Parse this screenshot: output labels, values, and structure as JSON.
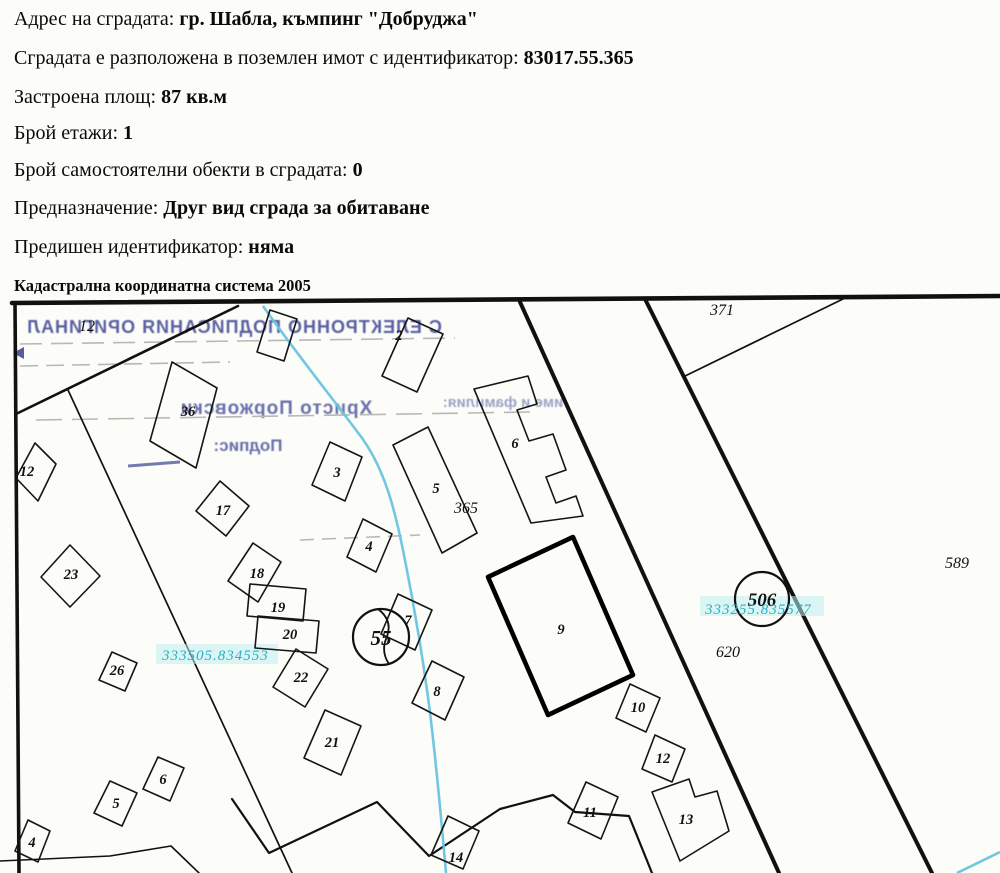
{
  "header": {
    "rows": [
      {
        "label": "Адрес на сградата: ",
        "value": "гр. Шабла, къмпинг \"Добруджа\""
      },
      {
        "label": "Сградата е разположена в поземлен имот с идентификатор: ",
        "value": "83017.55.365"
      },
      {
        "label": "Застроена площ: ",
        "value": "87 кв.м"
      },
      {
        "label": "Брой етажи: ",
        "value": "1"
      },
      {
        "label": "Брой самостоятелни обекти в сградата: ",
        "value": "0"
      },
      {
        "label": "Предназначение: ",
        "value": "Друг вид сграда за обитаване"
      },
      {
        "label": "Предишен идентификатор: ",
        "value": "няма"
      }
    ],
    "coord_system": "Кадастрална координатна система 2005"
  },
  "map": {
    "stamp": {
      "line1": "С ЕЛЕКТРОННО ПОДПИСАНИЯ ОРИГИНАЛ",
      "line2_label": "име и фамилия:",
      "line2_name": "Христо Поржовски",
      "line3": "Подпис:"
    },
    "colors": {
      "stream_blue": "#69c4e0",
      "cyan_label": "#2ab0c4",
      "stamp_blue": "#2b358a"
    },
    "labels": [
      {
        "text": "12",
        "x": 87,
        "y": 331,
        "cls": "parcel"
      },
      {
        "text": "371",
        "x": 722,
        "y": 315,
        "cls": "parcel"
      },
      {
        "text": "365",
        "x": 466,
        "y": 513,
        "cls": "parcel"
      },
      {
        "text": "589",
        "x": 957,
        "y": 568,
        "cls": "parcel"
      },
      {
        "text": "620",
        "x": 728,
        "y": 657,
        "cls": "parcel"
      },
      {
        "text": "2",
        "x": 399,
        "y": 340,
        "cls": "bldg"
      },
      {
        "text": "36",
        "x": 188,
        "y": 416,
        "cls": "bldg"
      },
      {
        "text": "3",
        "x": 337,
        "y": 477,
        "cls": "bldg"
      },
      {
        "text": "17",
        "x": 223,
        "y": 515,
        "cls": "bldg"
      },
      {
        "text": "5",
        "x": 436,
        "y": 493,
        "cls": "bldg"
      },
      {
        "text": "6",
        "x": 515,
        "y": 448,
        "cls": "bldg"
      },
      {
        "text": "4",
        "x": 369,
        "y": 551,
        "cls": "bldg"
      },
      {
        "text": "23",
        "x": 71,
        "y": 579,
        "cls": "bldg"
      },
      {
        "text": "18",
        "x": 257,
        "y": 578,
        "cls": "bldg"
      },
      {
        "text": "19",
        "x": 278,
        "y": 612,
        "cls": "bldg"
      },
      {
        "text": "20",
        "x": 290,
        "y": 639,
        "cls": "bldg"
      },
      {
        "text": "26",
        "x": 117,
        "y": 675,
        "cls": "bldg"
      },
      {
        "text": "22",
        "x": 301,
        "y": 682,
        "cls": "bldg"
      },
      {
        "text": "21",
        "x": 332,
        "y": 747,
        "cls": "bldg"
      },
      {
        "text": "7",
        "x": 408,
        "y": 625,
        "cls": "bldg"
      },
      {
        "text": "8",
        "x": 437,
        "y": 696,
        "cls": "bldg"
      },
      {
        "text": "9",
        "x": 561,
        "y": 634,
        "cls": "bldg"
      },
      {
        "text": "10",
        "x": 638,
        "y": 712,
        "cls": "bldg"
      },
      {
        "text": "12",
        "x": 27,
        "y": 476,
        "cls": "bldg"
      },
      {
        "text": "12",
        "x": 663,
        "y": 763,
        "cls": "bldg"
      },
      {
        "text": "11",
        "x": 590,
        "y": 817,
        "cls": "bldg"
      },
      {
        "text": "13",
        "x": 686,
        "y": 824,
        "cls": "bldg"
      },
      {
        "text": "14",
        "x": 456,
        "y": 862,
        "cls": "bldg"
      },
      {
        "text": "4",
        "x": 32,
        "y": 847,
        "cls": "bldg"
      },
      {
        "text": "5",
        "x": 116,
        "y": 808,
        "cls": "bldg"
      },
      {
        "text": "6",
        "x": 163,
        "y": 784,
        "cls": "bldg"
      },
      {
        "text": "55",
        "x": 381,
        "y": 645,
        "cls": "big55"
      },
      {
        "text": "506",
        "x": 762,
        "y": 606,
        "cls": "big506"
      },
      {
        "text": "333505.834553",
        "x": 162,
        "y": 660,
        "cls": "cyan"
      },
      {
        "text": "333255.835577",
        "x": 705,
        "y": 614,
        "cls": "cyan"
      }
    ]
  }
}
